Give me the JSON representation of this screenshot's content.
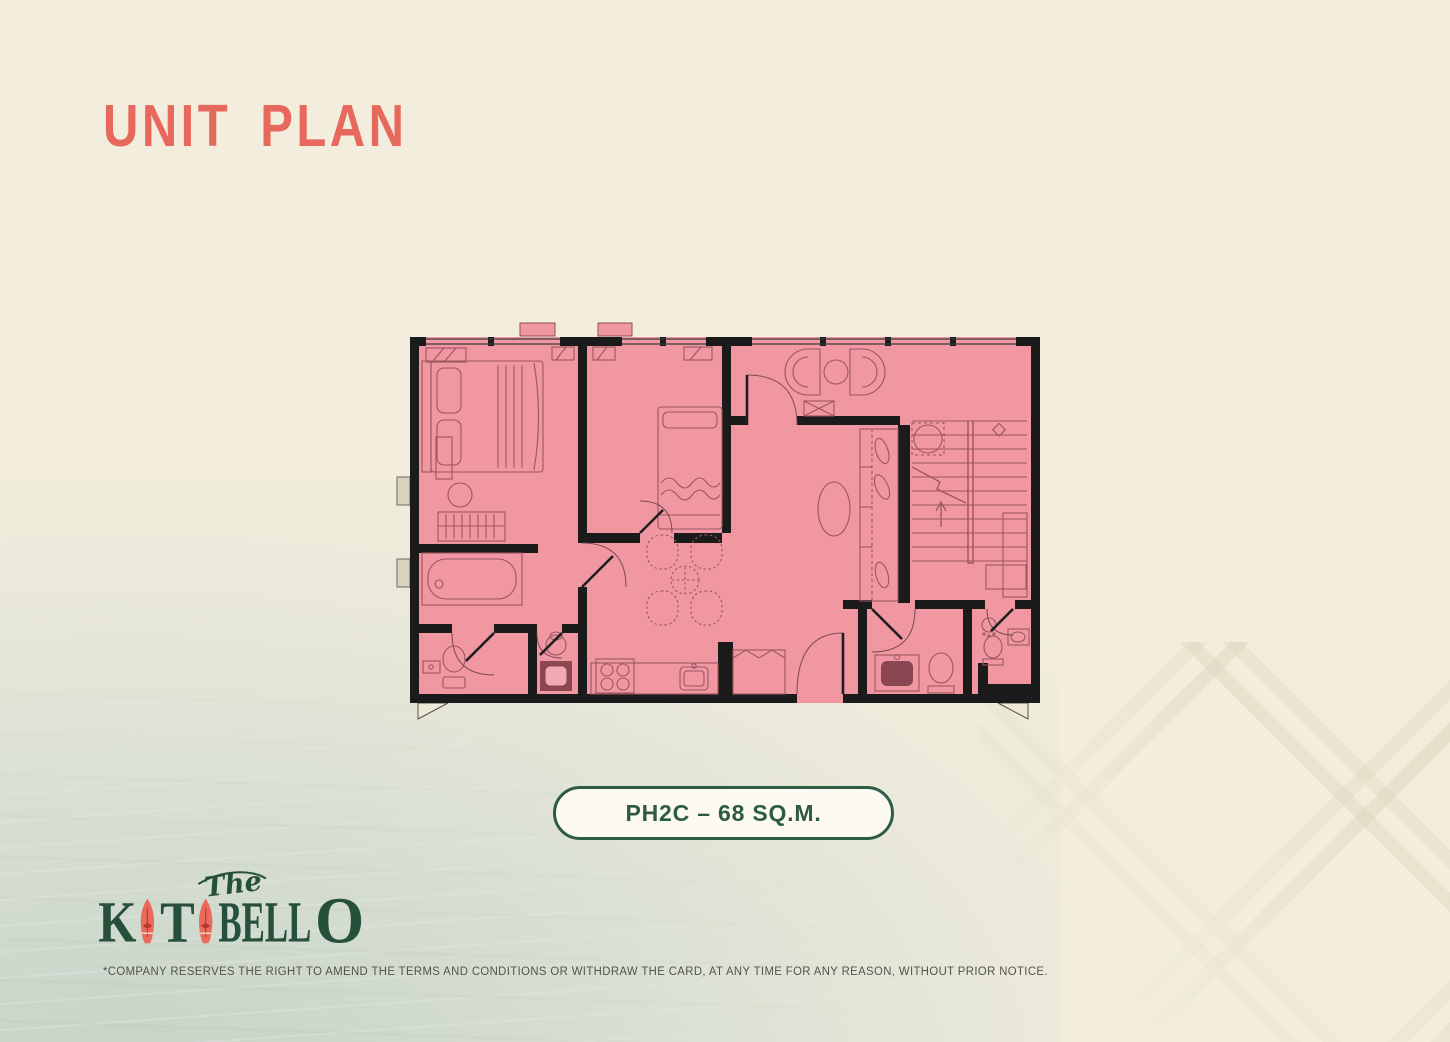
{
  "page": {
    "title": "UNIT PLAN",
    "disclaimer": "*COMPANY RESERVES THE RIGHT TO AMEND THE TERMS AND CONDITIONS OR WITHDRAW THE CARD, AT ANY TIME FOR ANY REASON, WITHOUT PRIOR NOTICE."
  },
  "unit_badge": {
    "label": "PH2C – 68 SQ.M.",
    "unit_code": "PH2C",
    "area_sqm": 68
  },
  "brand": {
    "prefix": "The",
    "k": "K",
    "t": "T",
    "bell": "BELL",
    "o": "O",
    "name": "KATABELLO"
  },
  "floor_plan": {
    "unit_code": "PH2C",
    "style": "architectural plan, pink room fill with black walls",
    "features": [
      "double-bed",
      "nightstand",
      "stool",
      "dresser",
      "bathtub",
      "water-closet",
      "powder-room",
      "single-bed",
      "wardrobe-ac-units",
      "dining-table-4-chairs",
      "kitchen-counter",
      "stove-4-burners",
      "kitchen-sink",
      "pantry-cabinet",
      "entry-door",
      "lounge-chairs-round-table",
      "console-table",
      "oval-coffee-table",
      "walk-in-closet",
      "round-side-table",
      "switchback-staircase",
      "bathroom-vanity",
      "toilet",
      "shower",
      "window-planters",
      "balcony-door-flags"
    ]
  },
  "colors": {
    "background_cream": "#F2EDDC",
    "accent_coral": "#E7695D",
    "brand_green": "#2D5C43",
    "plan_pink": "#F097A1",
    "wall_black": "#1B1B1B",
    "furniture_line": "#9B5661",
    "surfboard_coral": "#EC6A5B",
    "water_tint": "#CFD9CD"
  }
}
